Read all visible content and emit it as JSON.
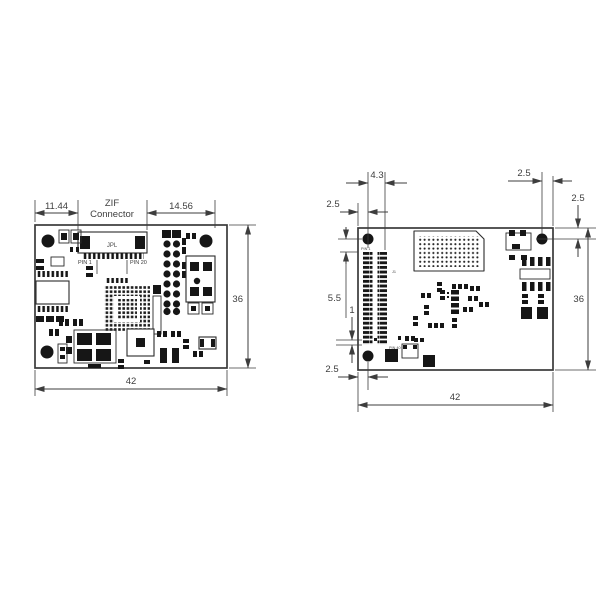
{
  "drawing": {
    "type": "pcb-dimension-drawing",
    "units_implied": "mm",
    "colors": {
      "line": "#3d3d3d",
      "component": "#161616",
      "text": "#3e3e3e",
      "background": "#ffffff"
    },
    "left_view": {
      "dim_left_width": "11.44",
      "dim_right_width": "14.56",
      "connector_label_line1": "ZIF",
      "connector_label_line2": "Connector",
      "connector_ref": "JPL",
      "pin_first": "PIN 1",
      "pin_last": "PIN 20",
      "dim_height": "36",
      "dim_total_width": "42"
    },
    "right_view": {
      "dim_hole_to_pads": "4.3",
      "dim_edge_to_hole_left": "2.5",
      "dim_hole_to_edge_right": "2.5",
      "dim_top_edge_to_hole": "2.5",
      "dim_hole_to_pin_row": "5.5",
      "dim_pad_pitch": "1",
      "dim_edge_to_hole_bottom": "2.5",
      "pin_first": "PIN 1",
      "pin_last": "PIN 40",
      "connector_ref": "J1",
      "dim_height": "36",
      "dim_total_width": "42"
    }
  }
}
